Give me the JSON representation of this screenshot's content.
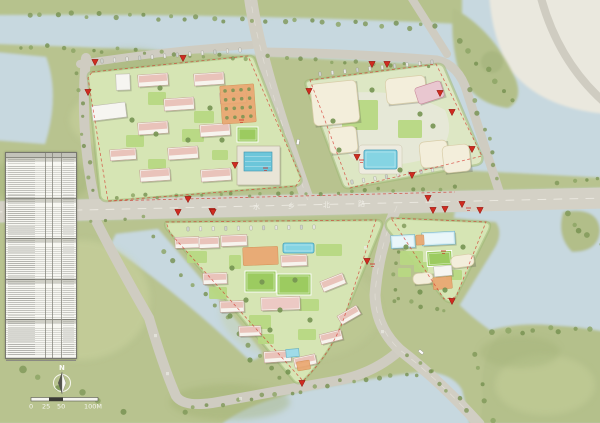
{
  "map": {
    "north_arrow": {
      "label": "N"
    },
    "scale_bar": {
      "ticks": [
        {
          "t": "0",
          "x": 29
        },
        {
          "t": "25",
          "x": 42
        },
        {
          "t": "50",
          "x": 57
        },
        {
          "t": "100M",
          "x": 84
        }
      ]
    },
    "road_labels": [
      {
        "text": "水",
        "x": 253,
        "y": 209
      },
      {
        "text": "乡",
        "x": 288,
        "y": 208
      },
      {
        "text": "北",
        "x": 323,
        "y": 207
      },
      {
        "text": "路",
        "x": 358,
        "y": 206
      }
    ],
    "illegible_marks": [
      [
        154,
        334
      ],
      [
        166,
        372
      ],
      [
        364,
        246
      ],
      [
        381,
        330
      ],
      [
        239,
        397
      ]
    ],
    "colors": {
      "water": "#c7d8df",
      "land": "#b8c38f",
      "block_green": "#d6e5b4",
      "road": "#d1cec3",
      "roof_pink": "#e9c3ba",
      "building_cream": "#f3eedb",
      "pool_cyan": "#85d4e3",
      "accent_orange": "#eaa771",
      "marker_red": "#cf2b20",
      "court_green": "#9ccb60",
      "headland_pale": "#eae8de"
    },
    "markers": [
      [
        95,
        64
      ],
      [
        183,
        60
      ],
      [
        88,
        94
      ],
      [
        235,
        167
      ],
      [
        188,
        201
      ],
      [
        428,
        200
      ],
      [
        212,
        213
      ],
      [
        433,
        212
      ],
      [
        462,
        206
      ],
      [
        372,
        66
      ],
      [
        387,
        66
      ],
      [
        309,
        93
      ],
      [
        440,
        95
      ],
      [
        452,
        114
      ],
      [
        472,
        151
      ],
      [
        357,
        159
      ],
      [
        412,
        177
      ],
      [
        178,
        214
      ],
      [
        213,
        214
      ],
      [
        302,
        385
      ],
      [
        367,
        263
      ],
      [
        445,
        211
      ],
      [
        480,
        212
      ],
      [
        452,
        303
      ]
    ],
    "red_notes": [
      [
        239,
        120
      ],
      [
        263,
        168
      ],
      [
        466,
        208
      ],
      [
        359,
        160
      ],
      [
        441,
        251
      ],
      [
        370,
        264
      ]
    ],
    "cars": [
      [
        298,
        142,
        -80
      ],
      [
        421,
        352,
        40
      ]
    ],
    "landscape": {
      "tree_rows": [
        [
          28,
          13,
          438,
          27,
          30,
          2.2
        ],
        [
          20,
          46,
          246,
          57,
          17,
          2.0
        ],
        [
          270,
          58,
          432,
          65,
          12,
          2.0
        ],
        [
          115,
          198,
          455,
          188,
          24,
          1.8
        ],
        [
          20,
          225,
          140,
          218,
          8,
          1.8
        ],
        [
          78,
          75,
          92,
          190,
          9,
          1.9
        ],
        [
          460,
          42,
          512,
          100,
          7,
          2.4
        ],
        [
          470,
          88,
          500,
          180,
          8,
          2.2
        ],
        [
          560,
          183,
          598,
          180,
          4,
          2.0
        ],
        [
          565,
          215,
          598,
          245,
          5,
          2.5
        ],
        [
          495,
          333,
          600,
          327,
          9,
          2.6
        ],
        [
          478,
          352,
          490,
          420,
          5,
          2.4
        ],
        [
          150,
          238,
          282,
          378,
          13,
          2.2
        ],
        [
          182,
          410,
          330,
          386,
          12,
          2.2
        ],
        [
          340,
          382,
          430,
          372,
          8,
          2.2
        ],
        [
          404,
          226,
          392,
          300,
          7,
          2.0
        ],
        [
          408,
          356,
          468,
          408,
          7,
          2.2
        ],
        [
          398,
          300,
          446,
          310,
          5,
          2.0
        ],
        [
          20,
          370,
          120,
          410,
          6,
          3.2
        ]
      ],
      "parking_rows": [
        [
          102,
          61,
          240,
          50,
          12
        ],
        [
          320,
          74,
          432,
          62,
          10
        ],
        [
          352,
          182,
          444,
          168,
          9
        ],
        [
          188,
          229,
          314,
          227,
          11
        ]
      ]
    },
    "blocks": {
      "nw": {
        "buildings": [
          [
            "res",
            138,
            74,
            30,
            12,
            -4
          ],
          [
            "res",
            194,
            73,
            30,
            12,
            -4
          ],
          [
            "res",
            164,
            98,
            30,
            12,
            -4
          ],
          [
            "res",
            220,
            92,
            26,
            11,
            -4
          ],
          [
            "res",
            138,
            122,
            30,
            12,
            -4
          ],
          [
            "res",
            200,
            124,
            30,
            12,
            -4
          ],
          [
            "res",
            168,
            147,
            30,
            12,
            -4
          ],
          [
            "res",
            110,
            149,
            26,
            11,
            -4
          ],
          [
            "res",
            140,
            169,
            30,
            12,
            -4
          ],
          [
            "res",
            201,
            169,
            30,
            12,
            -4
          ],
          [
            "white",
            92,
            104,
            34,
            15,
            -7
          ],
          [
            "white",
            116,
            74,
            14,
            16,
            -2
          ],
          [
            "orange",
            221,
            85,
            34,
            38,
            -4
          ],
          [
            "court",
            237,
            127,
            21,
            15,
            0
          ],
          [
            "school",
            237,
            146,
            43,
            39,
            0
          ],
          [
            "roof",
            244,
            152,
            28,
            19,
            0
          ],
          [
            "lawn",
            148,
            92,
            18,
            13,
            0
          ],
          [
            "lawn",
            194,
            111,
            20,
            12,
            0
          ],
          [
            "lawn",
            126,
            135,
            18,
            12,
            0
          ],
          [
            "lawn",
            182,
            129,
            22,
            13,
            0
          ],
          [
            "lawn",
            148,
            159,
            18,
            10,
            0
          ],
          [
            "lawn",
            212,
            150,
            16,
            10,
            0
          ]
        ],
        "groves": [
          [
            160,
            88
          ],
          [
            210,
            108
          ],
          [
            132,
            120
          ],
          [
            188,
            140
          ],
          [
            156,
            134
          ],
          [
            222,
            140
          ]
        ]
      },
      "ne": {
        "buildings": [
          [
            "cream",
            312,
            82,
            46,
            42,
            -6
          ],
          [
            "cream",
            386,
            77,
            40,
            26,
            -6
          ],
          [
            "cream",
            329,
            127,
            28,
            26,
            -6
          ],
          [
            "cream",
            420,
            141,
            28,
            26,
            -6
          ],
          [
            "cream",
            443,
            145,
            27,
            27,
            -6
          ],
          [
            "pink",
            416,
            84,
            27,
            17,
            -18
          ],
          [
            "pooldeck",
            359,
            145,
            43,
            29,
            0
          ],
          [
            "pool",
            364,
            150,
            33,
            19,
            0
          ],
          [
            "lawn",
            342,
            100,
            36,
            30,
            0
          ],
          [
            "lawn",
            398,
            120,
            24,
            18,
            0
          ]
        ],
        "groves": [
          [
            333,
            121
          ],
          [
            339,
            150
          ],
          [
            420,
            114
          ],
          [
            372,
            90
          ],
          [
            400,
            170
          ],
          [
            433,
            126
          ]
        ]
      },
      "sw": {
        "buildings": [
          [
            "res",
            175,
            237,
            24,
            11,
            -2
          ],
          [
            "res",
            199,
            237,
            20,
            11,
            -2
          ],
          [
            "res",
            221,
            235,
            26,
            11,
            -2
          ],
          [
            "orange",
            243,
            247,
            35,
            18,
            -2
          ],
          [
            "pool",
            283,
            243,
            31,
            10,
            0
          ],
          [
            "res",
            281,
            255,
            26,
            11,
            -2
          ],
          [
            "res",
            203,
            273,
            24,
            11,
            -2
          ],
          [
            "court",
            245,
            271,
            31,
            21,
            0
          ],
          [
            "court",
            277,
            274,
            34,
            21,
            0
          ],
          [
            "res",
            220,
            301,
            24,
            11,
            -2
          ],
          [
            "pinkbig",
            261,
            297,
            39,
            13,
            -2
          ],
          [
            "res",
            321,
            277,
            24,
            11,
            -22
          ],
          [
            "res",
            338,
            310,
            22,
            10,
            -30
          ],
          [
            "res",
            320,
            332,
            22,
            10,
            -14
          ],
          [
            "res",
            239,
            326,
            22,
            10,
            -2
          ],
          [
            "res",
            264,
            351,
            27,
            11,
            -4
          ],
          [
            "res",
            294,
            356,
            22,
            10,
            -12
          ],
          [
            "orange",
            297,
            361,
            13,
            9,
            -10
          ],
          [
            "cyanchip",
            286,
            349,
            13,
            8,
            -4
          ],
          [
            "lawn",
            187,
            251,
            20,
            12,
            0
          ],
          [
            "lawn",
            209,
            287,
            18,
            12,
            0
          ],
          [
            "lawn",
            249,
            315,
            22,
            14,
            0
          ],
          [
            "lawn",
            299,
            299,
            20,
            12,
            0
          ],
          [
            "lawn",
            298,
            329,
            18,
            11,
            0
          ],
          [
            "lawn",
            258,
            334,
            16,
            10,
            0
          ],
          [
            "lawn",
            229,
            255,
            12,
            14,
            0
          ],
          [
            "lawn",
            316,
            244,
            26,
            12,
            0
          ]
        ],
        "groves": [
          [
            232,
            268
          ],
          [
            262,
            282
          ],
          [
            310,
            320
          ],
          [
            280,
            310
          ],
          [
            246,
            300
          ],
          [
            295,
            280
          ],
          [
            230,
            316
          ],
          [
            270,
            330
          ],
          [
            250,
            360
          ],
          [
            288,
            372
          ]
        ]
      },
      "se": {
        "buildings": [
          [
            "cyan",
            391,
            235,
            24,
            13,
            -3
          ],
          [
            "cyan",
            422,
            232,
            33,
            13,
            -3
          ],
          [
            "orange",
            416,
            235,
            8,
            10,
            -3
          ],
          [
            "court",
            427,
            251,
            25,
            15,
            -3
          ],
          [
            "cream",
            451,
            255,
            23,
            12,
            -8
          ],
          [
            "white",
            434,
            266,
            18,
            10,
            -5
          ],
          [
            "cream",
            413,
            273,
            20,
            11,
            -5
          ],
          [
            "orange",
            433,
            277,
            19,
            12,
            -5
          ],
          [
            "lawn",
            400,
            251,
            23,
            14,
            0
          ],
          [
            "lawn",
            414,
            262,
            14,
            10,
            0
          ],
          [
            "lawn",
            446,
            270,
            16,
            10,
            0
          ],
          [
            "lawn",
            398,
            268,
            13,
            9,
            0
          ]
        ],
        "groves": [
          [
            463,
            247
          ],
          [
            406,
            247
          ],
          [
            445,
            290
          ],
          [
            420,
            292
          ]
        ]
      }
    },
    "indicators_table": {
      "sections": 5
    }
  }
}
